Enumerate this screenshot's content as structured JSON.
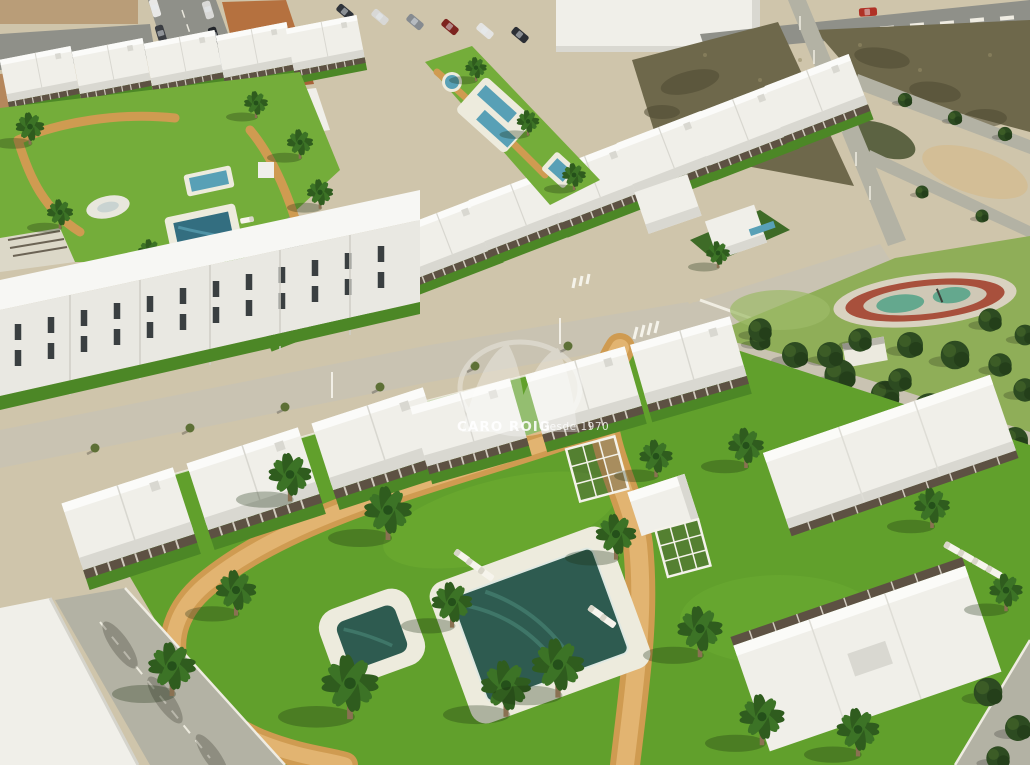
{
  "watermark": {
    "title": "CARO ROIG",
    "subtitle": "Desde 1970"
  },
  "palette": {
    "sand": "#cfc5ab",
    "sand_light": "#d9caa6",
    "asphalt": "#8f9089",
    "road_concrete": "#c9c3b2",
    "road_light": "#b3b2a4",
    "building_white": "#f0efe9",
    "building_shade": "#d9d8d1",
    "facade_white": "#e9e8e2",
    "pergola_brown": "#5d5143",
    "window_dark": "#3a3f41",
    "lawn_bright": "#61a02c",
    "lawn_top": "#74ad3a",
    "lawn_dark": "#4c8726",
    "park_green": "#8fae58",
    "tree_dark": "#2d4b21",
    "palm_green": "#2f5c1e",
    "palm_light": "#3c7326",
    "path_orange": "#cf9b51",
    "path_orange_light": "#e2b471",
    "pool_dark": "#2e5b50",
    "pool_blue": "#58a0b6",
    "pool_deck": "#edebdd",
    "field_olive": "#6e684b",
    "field_dark": "#4f4a33",
    "field_light": "#968d68",
    "terracotta": "#b5713f",
    "playground_red": "#a8503c",
    "playground_teal": "#64a88e",
    "car_red": "#b03126"
  },
  "scene": {
    "type": "aerial-3d-architectural-render",
    "areas": [
      "existing-town-streets",
      "new-townhouse-rows",
      "communal-gardens-with-pools",
      "vacant-scrub-field",
      "public-park-with-playground",
      "foreground-apartment-complex-with-main-pool",
      "palm-lined-lawns"
    ]
  }
}
